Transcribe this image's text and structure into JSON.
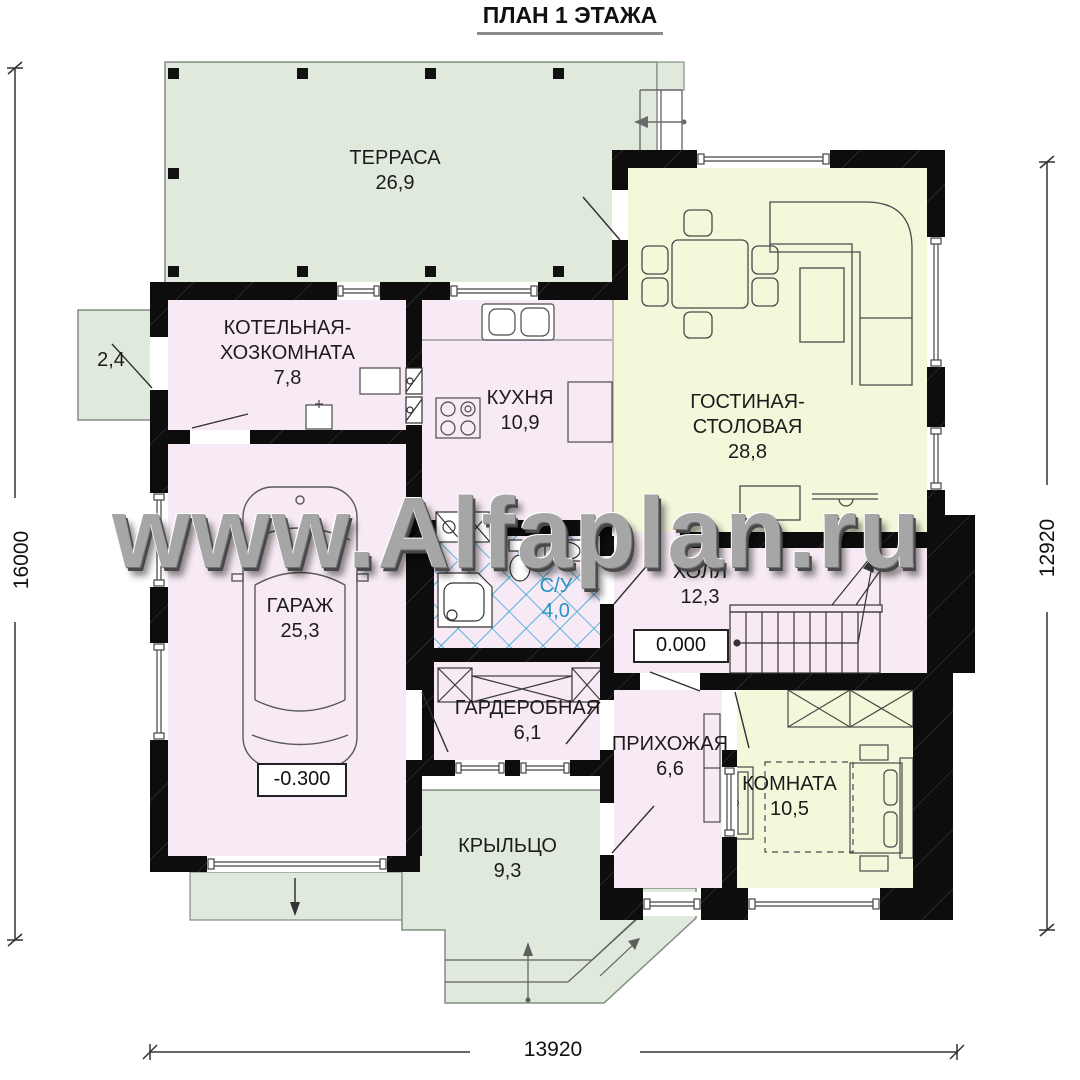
{
  "title": "ПЛАН 1 ЭТАЖА",
  "watermark": "www.Alfaplan.ru",
  "dimensions": {
    "left": "16000",
    "right": "12920",
    "bottom": "13920"
  },
  "colors": {
    "wall": "#0d0d0d",
    "terrace_green": "#dfe9dc",
    "room_pink": "#f7eaf4",
    "room_yellow": "#f5f7db",
    "tile_blue": "#2aa3d2"
  },
  "rooms": {
    "terrace": {
      "name": "ТЕРРАСА",
      "area": "26,9"
    },
    "platform": {
      "area": "2,4"
    },
    "boiler": {
      "name1": "КОТЕЛЬНАЯ-",
      "name2": "ХОЗКОМНАТА",
      "area": "7,8"
    },
    "kitchen": {
      "name": "КУХНЯ",
      "area": "10,9"
    },
    "living": {
      "name1": "ГОСТИНАЯ-",
      "name2": "СТОЛОВАЯ",
      "area": "28,8"
    },
    "garage": {
      "name": "ГАРАЖ",
      "area": "25,3",
      "level": "-0.300"
    },
    "bathroom": {
      "name": "С/У",
      "area": "4,0"
    },
    "hall": {
      "name": "ХОЛЛ",
      "area": "12,3",
      "level": "0.000"
    },
    "wardrobe": {
      "name": "ГАРДЕРОБНАЯ",
      "area": "6,1"
    },
    "entry": {
      "name": "ПРИХОЖАЯ",
      "area": "6,6"
    },
    "bedroom": {
      "name": "КОМНАТА",
      "area": "10,5"
    },
    "porch": {
      "name": "КРЫЛЬЦО",
      "area": "9,3"
    }
  }
}
